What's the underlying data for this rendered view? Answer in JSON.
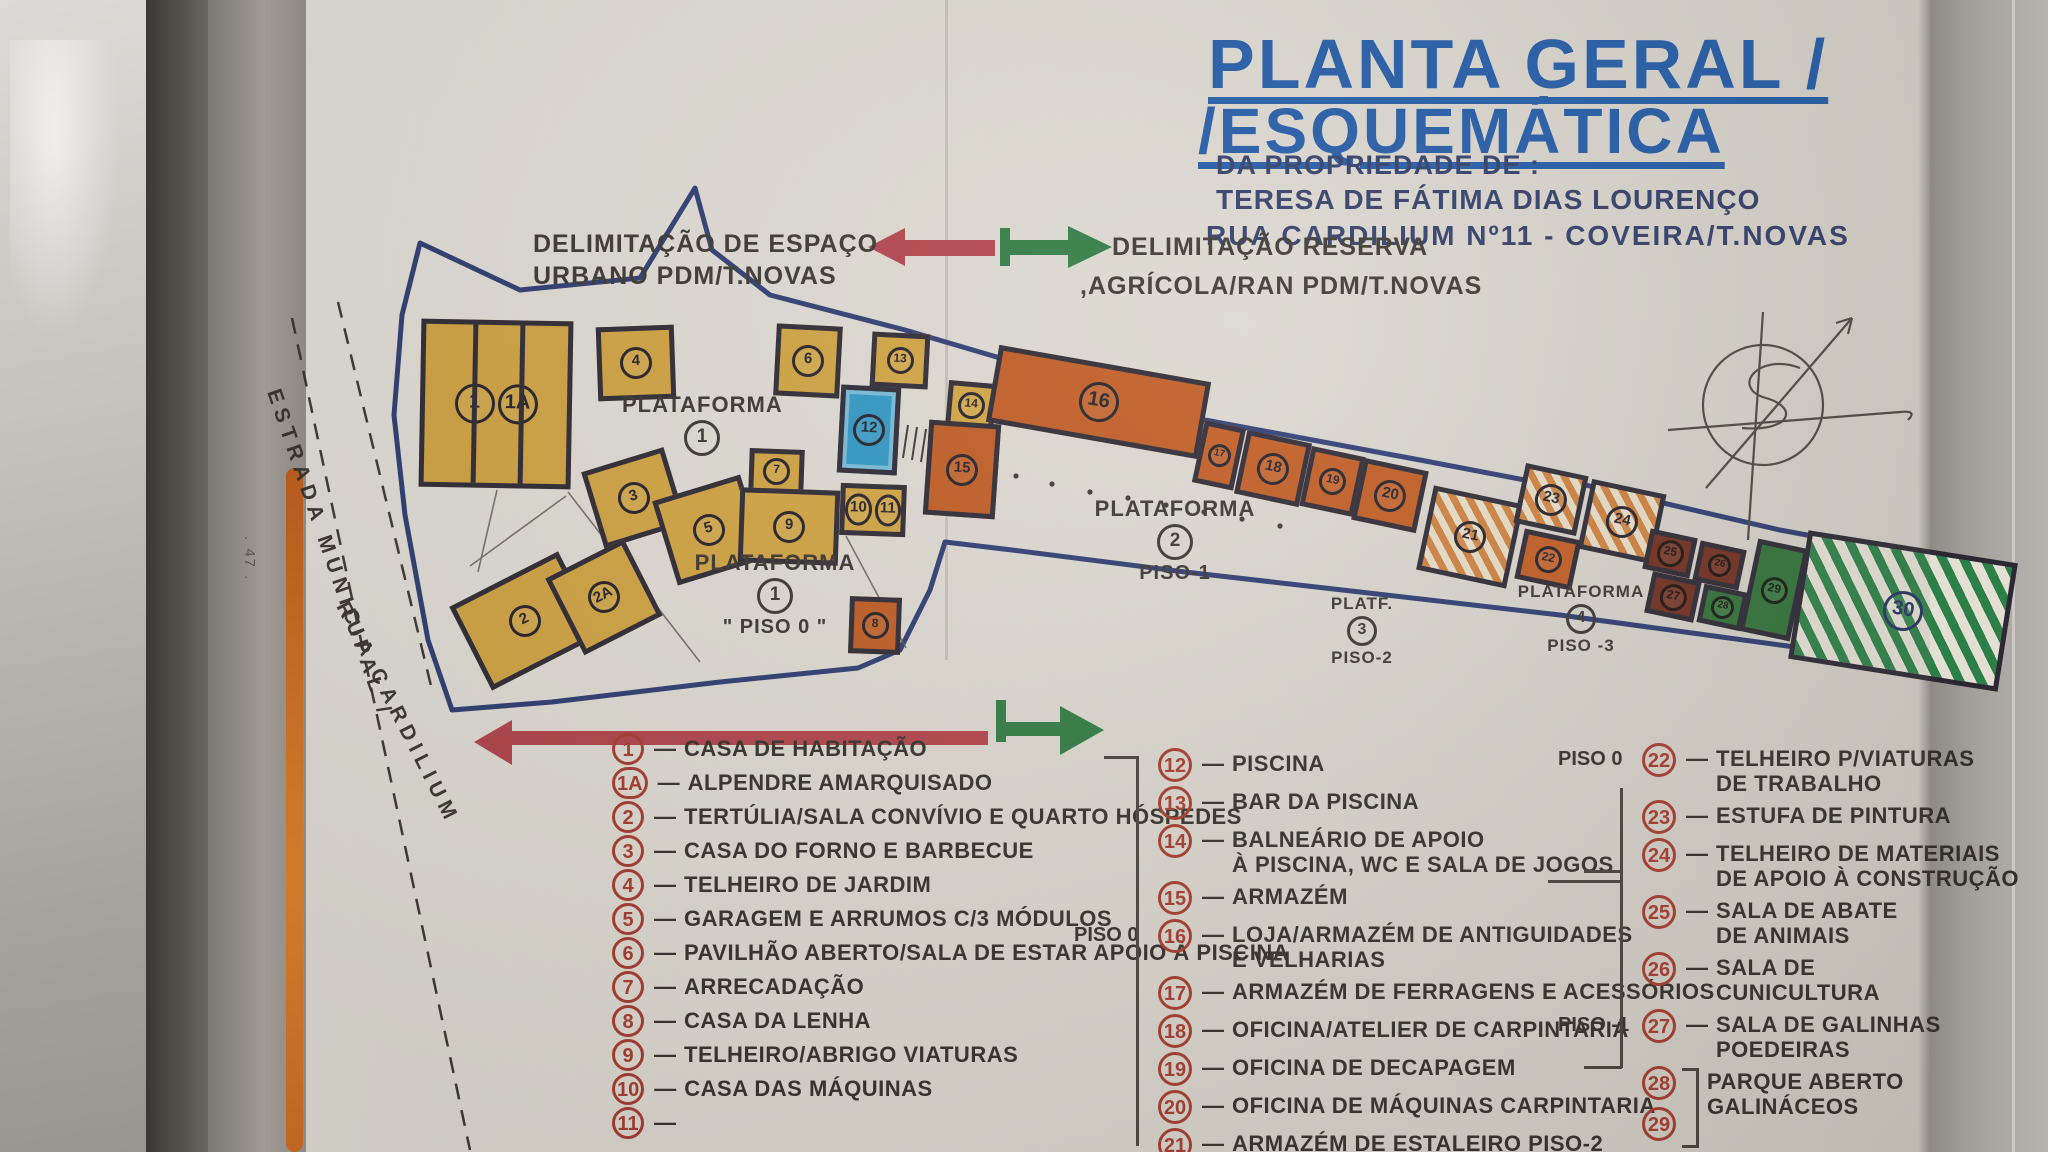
{
  "photo": {
    "page_number": ". 47 ."
  },
  "title": {
    "line1": "PLANTA GERAL /",
    "line2": "/ESQUEMÁTICA",
    "owner_label": "DA PROPRIEDADE DE :",
    "owner_name": "TERESA DE FÁTIMA DIAS LOURENÇO",
    "address": "RUA CARDILIUM Nº11 - COVEIRA/T.NOVAS"
  },
  "annotations": {
    "urban_line1": "DELIMITAÇÃO DE ESPAÇO",
    "urban_line2": "URBANO PDM/T.NOVAS",
    "reserve_line1": "DELIMITAÇÃO RESERVA",
    "reserve_line2": ",AGRÍCOLA/RAN PDM/T.NOVAS",
    "road_line1": "ESTRADA MUNICIPAL /",
    "road_line2": "RUA CARDILIUM"
  },
  "colors": {
    "title_blue": "#1e57a4",
    "ink": "#332e29",
    "legend_red": "#a63a2d",
    "arrow_red": "#b2424a",
    "arrow_green": "#2e7a42",
    "boundary_blue": "#2b3b72",
    "building_yellow": "#d2a440",
    "building_orange": "#c05a20",
    "pool_blue": "#2e96c4",
    "dark_green": "#2f7036",
    "maroon": "#6f2d1d"
  },
  "map": {
    "platforms": [
      {
        "name": "PLATAFORMA",
        "num": "1",
        "sub": "",
        "x": 622,
        "y": 392,
        "w": 160
      },
      {
        "name": "PLATAFORMA",
        "num": "1",
        "sub": "\" PISO 0 \"",
        "x": 690,
        "y": 550,
        "w": 170
      },
      {
        "name": "PLATAFORMA",
        "num": "2",
        "sub": "PISO-1",
        "x": 1090,
        "y": 496,
        "w": 170
      },
      {
        "name": "PLATF.",
        "num": "3",
        "sub": "PISO-2",
        "x": 1302,
        "y": 594,
        "w": 120,
        "small": true
      },
      {
        "name": "PLATAFORMA",
        "num": "4",
        "sub": "PISO -3",
        "x": 1506,
        "y": 582,
        "w": 150,
        "small": true
      }
    ],
    "buildings": [
      {
        "n": "1",
        "n2": "1A",
        "type": "yellow",
        "x": 420,
        "y": 320,
        "w": 152,
        "h": 168,
        "rot": 1,
        "stripes": true
      },
      {
        "n": "4",
        "type": "yellow",
        "x": 597,
        "y": 326,
        "w": 78,
        "h": 74,
        "rot": -2
      },
      {
        "n": "3",
        "type": "yellow",
        "x": 591,
        "y": 458,
        "w": 86,
        "h": 80,
        "rot": -17
      },
      {
        "n": "5",
        "type": "yellow",
        "x": 663,
        "y": 486,
        "w": 92,
        "h": 88,
        "rot": -17
      },
      {
        "n": "2",
        "type": "yellow",
        "x": 464,
        "y": 574,
        "w": 122,
        "h": 94,
        "rot": -27
      },
      {
        "n": "2A",
        "type": "yellow",
        "x": 560,
        "y": 554,
        "w": 88,
        "h": 86,
        "rot": -27
      },
      {
        "n": "6",
        "type": "yellow",
        "x": 775,
        "y": 325,
        "w": 66,
        "h": 72,
        "rot": 3
      },
      {
        "n": "13",
        "type": "yellow",
        "x": 871,
        "y": 333,
        "w": 58,
        "h": 55,
        "rot": 3
      },
      {
        "n": "14",
        "type": "yellow",
        "x": 947,
        "y": 382,
        "w": 48,
        "h": 47,
        "rot": 5
      },
      {
        "n": "12",
        "type": "pool",
        "x": 839,
        "y": 386,
        "w": 60,
        "h": 88,
        "rot": 3
      },
      {
        "n": "7",
        "type": "yellow",
        "x": 749,
        "y": 449,
        "w": 55,
        "h": 45,
        "rot": 2
      },
      {
        "n": "9",
        "type": "yellow",
        "x": 739,
        "y": 489,
        "w": 100,
        "h": 75,
        "rot": 2
      },
      {
        "n": "10",
        "n2": "11",
        "type": "yellow",
        "x": 840,
        "y": 484,
        "w": 66,
        "h": 52,
        "rot": 2
      },
      {
        "n": "8",
        "type": "orange",
        "x": 849,
        "y": 597,
        "w": 52,
        "h": 57,
        "rot": 2
      },
      {
        "n": "15",
        "type": "orange",
        "x": 926,
        "y": 422,
        "w": 72,
        "h": 95,
        "rot": 4
      },
      {
        "n": "16",
        "type": "orange",
        "x": 991,
        "y": 363,
        "w": 215,
        "h": 78,
        "rot": 10
      },
      {
        "n": "17",
        "type": "orange",
        "x": 1198,
        "y": 424,
        "w": 42,
        "h": 63,
        "rot": 12
      },
      {
        "n": "18",
        "type": "orange",
        "x": 1240,
        "y": 436,
        "w": 66,
        "h": 65,
        "rot": 12
      },
      {
        "n": "19",
        "type": "orange",
        "x": 1305,
        "y": 451,
        "w": 55,
        "h": 61,
        "rot": 12
      },
      {
        "n": "20",
        "type": "orange",
        "x": 1357,
        "y": 464,
        "w": 66,
        "h": 63,
        "rot": 12
      },
      {
        "n": "21",
        "type": "hatch-orange",
        "x": 1424,
        "y": 494,
        "w": 92,
        "h": 86,
        "rot": 12
      },
      {
        "n": "23",
        "type": "hatch-orange",
        "x": 1519,
        "y": 469,
        "w": 64,
        "h": 61,
        "rot": 12
      },
      {
        "n": "24",
        "type": "hatch-orange",
        "x": 1584,
        "y": 486,
        "w": 76,
        "h": 71,
        "rot": 12
      },
      {
        "n": "22",
        "type": "orange",
        "x": 1519,
        "y": 534,
        "w": 58,
        "h": 51,
        "rot": 12
      },
      {
        "n": "25",
        "type": "maroon",
        "x": 1646,
        "y": 533,
        "w": 48,
        "h": 41,
        "rot": 12
      },
      {
        "n": "26",
        "type": "maroon",
        "x": 1696,
        "y": 545,
        "w": 47,
        "h": 41,
        "rot": 12
      },
      {
        "n": "27",
        "type": "maroon",
        "x": 1648,
        "y": 576,
        "w": 50,
        "h": 42,
        "rot": 12
      },
      {
        "n": "28",
        "type": "green",
        "x": 1700,
        "y": 588,
        "w": 45,
        "h": 39,
        "rot": 12
      },
      {
        "n": "29",
        "type": "green",
        "x": 1748,
        "y": 543,
        "w": 52,
        "h": 94,
        "rot": 12
      },
      {
        "n": "30",
        "type": "hatch-green",
        "x": 1797,
        "y": 546,
        "w": 212,
        "h": 130,
        "rot": 9
      }
    ]
  },
  "legend": {
    "dash": "—",
    "col1": [
      {
        "num": "1",
        "text": "CASA DE HABITAÇÃO"
      },
      {
        "num": "1A",
        "text": "ALPENDRE AMARQUISADO"
      },
      {
        "num": "2",
        "text": "TERTÚLIA/SALA CONVÍVIO E QUARTO HÓSPEDES"
      },
      {
        "num": "3",
        "text": "CASA DO FORNO E BARBECUE"
      },
      {
        "num": "4",
        "text": "TELHEIRO DE JARDIM"
      },
      {
        "num": "5",
        "text": "GARAGEM E ARRUMOS C/3 MÓDULOS"
      },
      {
        "num": "6",
        "text": "PAVILHÃO ABERTO/SALA DE ESTAR APOIO À PISCINA"
      },
      {
        "num": "7",
        "text": "ARRECADAÇÃO"
      },
      {
        "num": "8",
        "text": "CASA DA LENHA"
      },
      {
        "num": "9",
        "text": "TELHEIRO/ABRIGO VIATURAS"
      },
      {
        "num": "10",
        "text": "CASA DAS MÁQUINAS"
      },
      {
        "num": "11",
        "text": ""
      }
    ],
    "col2": [
      {
        "num": "12",
        "text": "PISCINA"
      },
      {
        "num": "13",
        "text": "BAR DA PISCINA"
      },
      {
        "num": "14",
        "text": "BALNEÁRIO DE APOIO",
        "text2": "À PISCINA, WC E SALA DE JOGOS"
      },
      {
        "num": "15",
        "text": "ARMAZÉM"
      },
      {
        "num": "16",
        "text": "LOJA/ARMAZÉM DE ANTIGUIDADES",
        "text2": "E VELHARIAS",
        "piso": "PISO 0"
      },
      {
        "num": "17",
        "text": "ARMAZÉM DE FERRAGENS E ACESSÓRIOS"
      },
      {
        "num": "18",
        "text": "OFICINA/ATELIER DE CARPINTARIA"
      },
      {
        "num": "19",
        "text": "OFICINA DE DECAPAGEM"
      },
      {
        "num": "20",
        "text": "OFICINA DE MÁQUINAS CARPINTARIA"
      },
      {
        "num": "21",
        "text": "ARMAZÉM DE ESTALEIRO PISO-2"
      }
    ],
    "col3": [
      {
        "num": "22",
        "text": "TELHEIRO P/VIATURAS",
        "text2": "DE TRABALHO",
        "piso": "PISO 0"
      },
      {
        "num": "23",
        "text": "ESTUFA DE PINTURA"
      },
      {
        "num": "24",
        "text": "TELHEIRO DE MATERIAIS",
        "text2": "DE APOIO À CONSTRUÇÃO"
      },
      {
        "num": "25",
        "text": "SALA DE ABATE",
        "text2": "DE ANIMAIS"
      },
      {
        "num": "26",
        "text": "SALA DE",
        "text2": "CUNICULTURA"
      },
      {
        "num": "27",
        "text": "SALA DE GALINHAS",
        "text2": "POEDEIRAS",
        "piso": "PISO -1"
      },
      {
        "num": "28",
        "num2": "29",
        "text": "PARQUE ABERTO",
        "text2": "GALINÁCEOS"
      },
      {
        "num": "30",
        "text": "TERRENO RESTANTE"
      }
    ]
  }
}
